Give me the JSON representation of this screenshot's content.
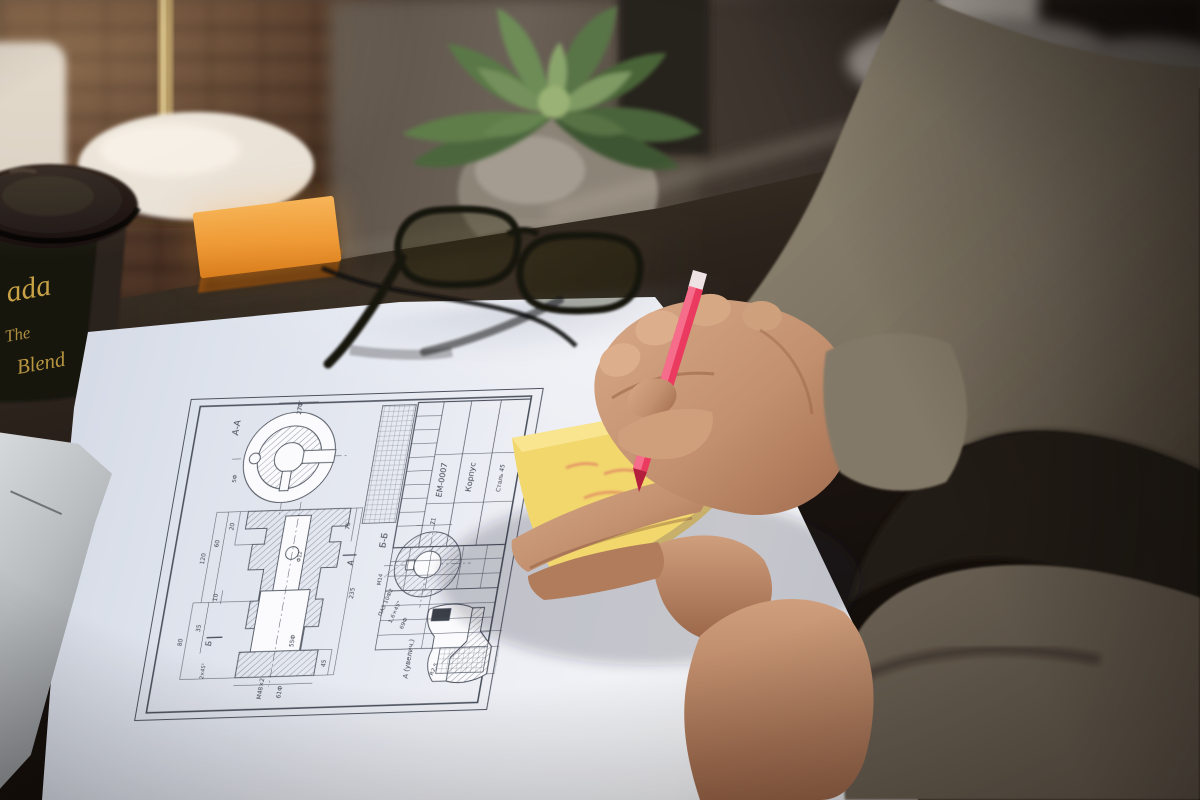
{
  "meta": {
    "description": "Photograph: a person's hands writing on a yellow sticky note with a pink felt-tip pen above a Russian engineering blueprint lying on a dark glass desk, with a coffee cup, succulent plant, lamp, glasses and laptop around."
  },
  "palette": {
    "paper": "#eceef4",
    "pen": "#ea3a5f",
    "sticky_note": "#f2d76d",
    "sticky_stack": "#ef9b36",
    "cup": "#17120f",
    "cup_gold": "#c9a246",
    "sleeve": "#847a69",
    "skin": "#c79a79",
    "plant": "#5f7d49",
    "desk": "#1b1410"
  },
  "cup": {
    "fragment_top": "ada",
    "fragment_mid": "The",
    "fragment_bottom": "Blend"
  },
  "drawing": {
    "labels": {
      "section_top": "А-А",
      "section_round": "Б-Б",
      "detail": "А (увелич.)",
      "view_a": "А",
      "view_b": "Б"
    },
    "title_block": {
      "doc_number": "ЕМ-0007",
      "part_name": "Корпус",
      "material": "Сталь 45"
    },
    "dims": [
      "120",
      "60",
      "20",
      "10",
      "35",
      "80",
      "2×45°",
      "27Ф",
      "5Ф",
      "Ф12",
      "55Ф",
      "М48×2",
      "61Ф",
      "235",
      "75",
      "45",
      "М14",
      "71",
      "ПАЗ 10Ф2",
      "1,6×45°",
      "69Ф",
      "R2,5",
      "12,5",
      "18,5"
    ]
  }
}
